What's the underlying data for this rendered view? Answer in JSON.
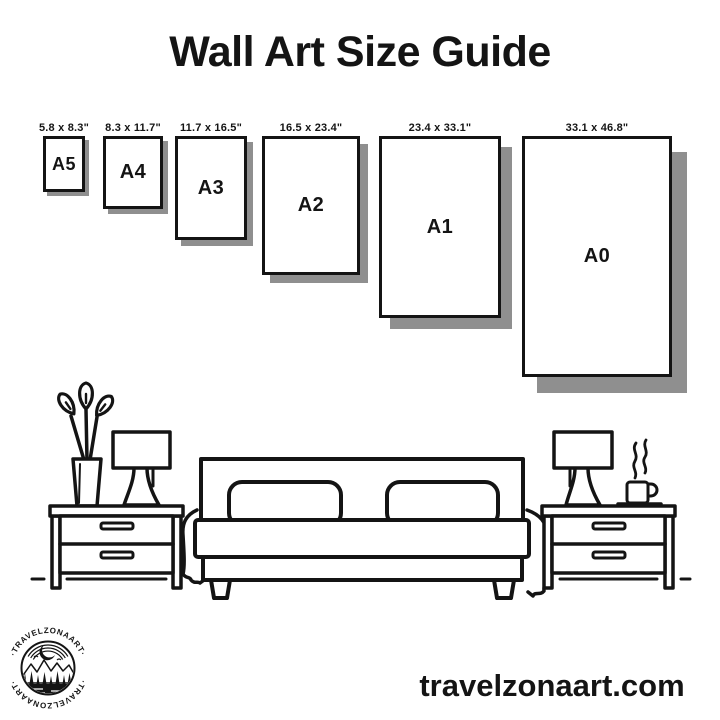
{
  "title": "Wall Art Size Guide",
  "sizes": [
    {
      "name": "A5",
      "dimensions": "5.8 x 8.3\""
    },
    {
      "name": "A4",
      "dimensions": "8.3 x 11.7\""
    },
    {
      "name": "A3",
      "dimensions": "11.7 x 16.5\""
    },
    {
      "name": "A2",
      "dimensions": "16.5 x 23.4\""
    },
    {
      "name": "A1",
      "dimensions": "23.4 x 33.1\""
    },
    {
      "name": "A0",
      "dimensions": "33.1 x 46.8\""
    }
  ],
  "illustration": {
    "elements": [
      "potted-plant",
      "table-lamp-left",
      "nightstand-left",
      "double-bed",
      "pillows",
      "nightstand-right",
      "table-lamp-right",
      "steaming-coffee-cup",
      "floor-line"
    ]
  },
  "logo": {
    "text_top": "·TRAVELZONAART·",
    "text_bottom": "·TRAVELZONAART·"
  },
  "footer": {
    "website": "travelzonaart.com"
  },
  "colors": {
    "ink": "#141414",
    "shadow": "#8f8f8f",
    "background": "#ffffff"
  }
}
